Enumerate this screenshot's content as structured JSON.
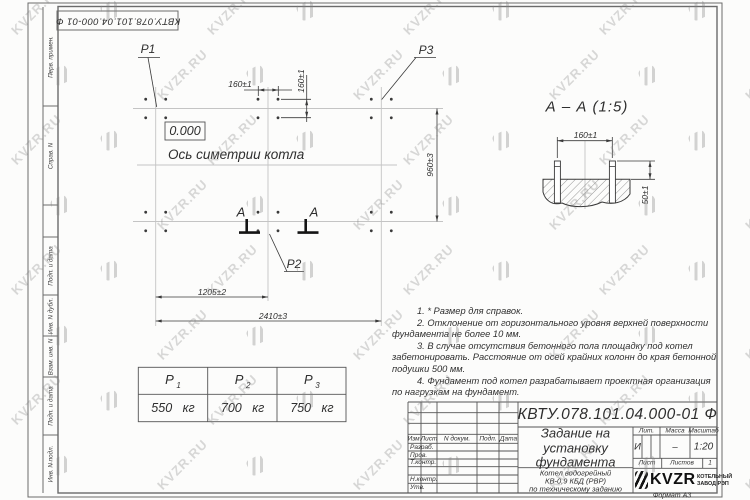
{
  "watermark": {
    "text": "KVZR.RU"
  },
  "top_stamp": {
    "doc_number": "КВТУ.078.101.04.000-01 Ф"
  },
  "margin_column": {
    "labels": [
      "Перв. примен.",
      "Справ. N",
      "Подп. и дата",
      "Инв. N дубл.",
      "Взам. инв. N",
      "Подп. и дата",
      "Инв. N подл."
    ]
  },
  "plan": {
    "point_labels": {
      "p1": "P1",
      "p2": "P2",
      "p3": "P3"
    },
    "level_mark": "0.000",
    "axis_label": "Ось симетрии котла",
    "section_letters": {
      "left": "А",
      "right": "А"
    },
    "dimensions": {
      "bolt_pitch_x": "160±1",
      "bolt_pitch_y": "160±1",
      "row_spacing": "960±3",
      "half_span": "1205±2",
      "full_span": "2410±3"
    }
  },
  "section_view": {
    "title": "А – А (1:5)",
    "dimensions": {
      "bolt_pitch": "160±1",
      "bolt_protrusion": "50±1"
    }
  },
  "load_table": {
    "columns": [
      {
        "symbol": "P",
        "sub": "1",
        "value": "550 кг"
      },
      {
        "symbol": "P",
        "sub": "2",
        "value": "700 кг"
      },
      {
        "symbol": "P",
        "sub": "3",
        "value": "750 кг"
      }
    ]
  },
  "notes": {
    "items": [
      "1.  * Размер для справок.",
      "2.  Отклонение от горизонтального уровня верхней поверхности фундамента не более 10 мм.",
      "3.  В случае отсутствия бетонного пола площадку под котел забетонировать. Расстояние от осей крайних колонн до края бетонной подушки 500 мм.",
      "4.  Фундамент под котел разрабатывает проектная организация по нагрузкам на фундамент."
    ]
  },
  "title_block": {
    "doc_number": "КВТУ.078.101.04.000-01 Ф",
    "title_lines": [
      "Задание на",
      "установку",
      "фундамента"
    ],
    "subtitle_lines": [
      "Котел водогрейный",
      "КВ-0,9 КБД (РВР)",
      "по техническому заданию"
    ],
    "header_row": {
      "izm": "Изм.",
      "list": "Лист",
      "n_dokum": "N докум.",
      "podp": "Подп.",
      "data": "Дата"
    },
    "rows": [
      "Разраб.",
      "Пров.",
      "Т.контр.",
      "Н.контр.",
      "Утв."
    ],
    "lit_header": "Лит.",
    "massa_header": "Масса",
    "masshtab_header": "Масштаб",
    "lit_value": "И",
    "massa_value": "–",
    "masshtab_value": "1:20",
    "list_label": "Лист",
    "listov_label": "Листов",
    "listov_value": "1",
    "logo": {
      "name": "KVZR",
      "caption_lines": [
        "КОТЕЛЬНЫЙ",
        "ЗАВОД РЭП"
      ]
    },
    "format_label": "Формат А3"
  }
}
